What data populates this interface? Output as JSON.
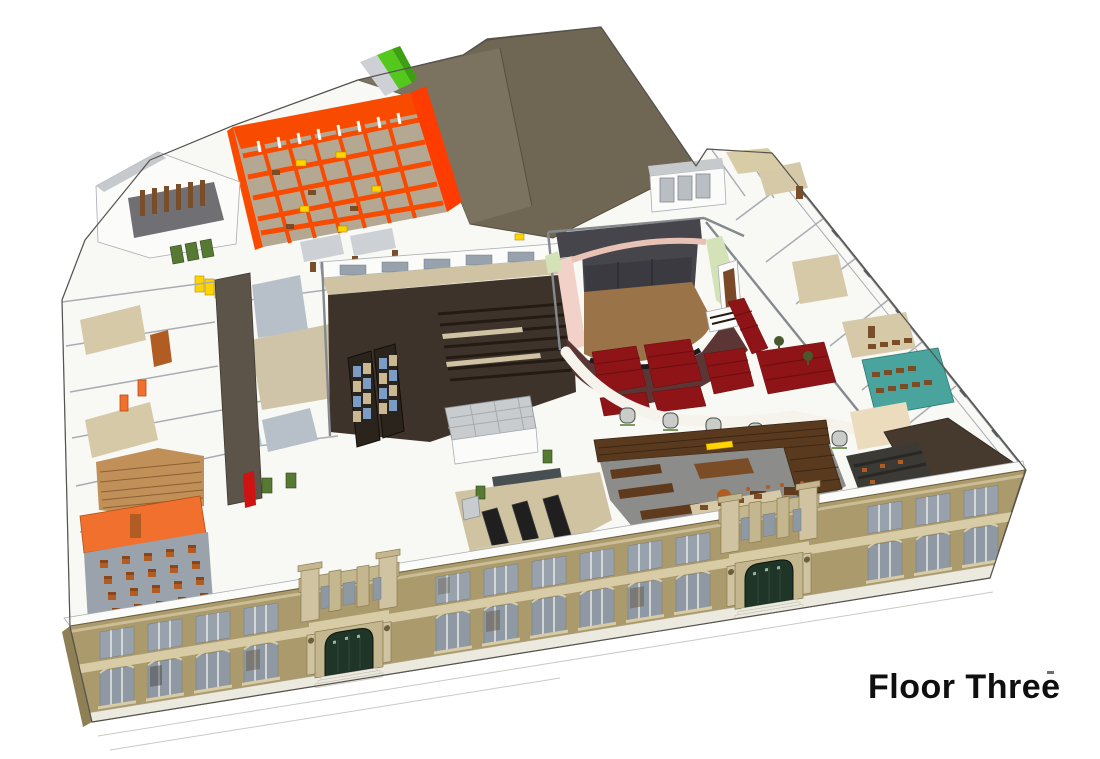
{
  "annotation": {
    "text": "Floor Three"
  },
  "scene": {
    "name": "building-floor-three-axonometric-cutaway",
    "view": "aerial cutaway 3d rendering of a school and theater building, third floor exposed",
    "regions": [
      {
        "name": "stage-house",
        "feature": "tall windowless fly-tower block",
        "palette": "stagehouse"
      },
      {
        "name": "orange-wing",
        "feature": "orange open-frame wing with grid of bays and study furniture",
        "palette": "orange"
      },
      {
        "name": "rooftop-green-wedges",
        "feature": "small bright green roof wedges",
        "palette": "green_bright"
      },
      {
        "name": "northwest-stair-block",
        "feature": "stair penthouse with brown posts",
        "palette": "post_brown"
      },
      {
        "name": "green-door-trio",
        "feature": "three green doors",
        "palette": "green_door"
      },
      {
        "name": "yellow-lockers",
        "feature": "yellow locker bank",
        "palette": "yellow"
      },
      {
        "name": "corridor-spine",
        "feature": "dark corridor running front to back",
        "palette": "corridor"
      },
      {
        "name": "west-classrooms",
        "feature": "small rooms with tan and blue-gray floors, orange doors, one red door",
        "palette": "blue_gray"
      },
      {
        "name": "wood-floor-room",
        "feature": "plank floored room",
        "palette": "wood"
      },
      {
        "name": "gym-hall",
        "feature": "dark double-height hall with bleachers and stained-glass doors",
        "palette": "gym_dark"
      },
      {
        "name": "skylight-penthouse",
        "feature": "gray skylight box",
        "palette": "skylight"
      },
      {
        "name": "lab-room",
        "feature": "room with three long black benches",
        "palette": "bench_black"
      },
      {
        "name": "theater",
        "feature": "auditorium with pink proscenium, green walls, brown stage, dark red seating",
        "palette": "seat_red"
      },
      {
        "name": "balcony-arcade",
        "feature": "white curved balcony front over arched openings",
        "palette": "arch_gray"
      },
      {
        "name": "library",
        "feature": "reading room ringed by dark bookshelves with desks and round table",
        "palette": "shelf_brown"
      },
      {
        "name": "teal-classroom",
        "feature": "teal floored classroom with brown desks",
        "palette": "teal"
      },
      {
        "name": "corner-dark-room",
        "feature": "dark brown room at right corner",
        "palette": "dark_room"
      },
      {
        "name": "front-classroom",
        "feature": "classroom with orange wall and grid of orange chairs",
        "palette": "class_orange"
      },
      {
        "name": "facade",
        "feature": "tan brick street facade with window bays and two stone entrance portals",
        "palette": "facade"
      },
      {
        "name": "entrance-portal-left",
        "feature": "stone portal, green doors, steps",
        "palette": "facade_stone"
      },
      {
        "name": "entrance-portal-right",
        "feature": "stone portal, green doors, steps",
        "palette": "facade_stone"
      },
      {
        "name": "ground-lines",
        "feature": "faint sidewalk lines",
        "palette": "ground_line"
      }
    ]
  },
  "palette": {
    "bg": "#ffffff",
    "ink": "#0f0f0f",
    "mark": "#6e6e6e",
    "edge": "#55534e",
    "plate": "#f8f8f5",
    "wall_top": "#a9adb2",
    "wall2": "#85898d",
    "tick": "#5a6068",
    "side_shadow": "#8e7f55",
    "facade": "#ab9a6c",
    "facade_edge": "#6b5f3a",
    "facade_trim": "#d8cca6",
    "facade_stone": "#cfc3a2",
    "facade_stone_dark": "#c4b78f",
    "stone_edge": "#8a7c50",
    "glass": "#97a2ac",
    "glass_dark": "#8e99a4",
    "glass_edge": "#767d84",
    "mullion": "#e8e8e8",
    "foundation": "#eceadf",
    "step_edge": "#b5b2a5",
    "door_green_dark": "#1f3527",
    "door_dark_edge": "#0a140e",
    "door_line": "#33493a",
    "door_speck": "#9fb3a4",
    "stagehouse": "#6f6654",
    "stagehouse_light": "#7b7260",
    "sh_edge": "#57503f",
    "orange": "#f84b00",
    "orange_bright": "#ff3c00",
    "orange_floor": "#b5a893",
    "yellow": "#ffd400",
    "yellow_edge": "#b08f00",
    "green_bright": "#55c81e",
    "green_bright_dark": "#3da012",
    "green_door": "#567a33",
    "green_door_edge": "#2e4418",
    "pink": "#f2d2c8",
    "pink_soft": "#e9c2b6",
    "mint": "#d4e2b8",
    "backdrop": "#45454b",
    "backdrop_dark": "#3a3a40",
    "backdrop_line": "#2c2c30",
    "stage_brown": "#9a7348",
    "pit": "#1c1c1c",
    "house_maroon": "#5b3634",
    "seat_red": "#8e1418",
    "seat_red_dark": "#6b0e10",
    "balcony": "#f6f3ec",
    "arch_gray": "#c9ccc9",
    "arch_edge": "#4a4f4a",
    "organ_brown": "#7a4a28",
    "tree_green": "#49592e",
    "trunk": "#5a4a32",
    "gym_dark": "#3e332a",
    "gym_beige": "#cfc3a4",
    "bleach_line": "#241c14",
    "door_panel": "#2b241c",
    "door_panel_edge": "#120e0a",
    "glass_blue": "#7b9cc4",
    "glass_tan": "#c9b892",
    "corridor": "#5d5449",
    "corridor_edge": "#3e382f",
    "slate": "#474f52",
    "skylight": "#c9ccce",
    "skylight_edge": "#8a8f93",
    "skylight_line": "#a6abaf",
    "lab_floor": "#cfc3a2",
    "bench_black": "#1f1f1f",
    "bench_edge": "#3a3a3a",
    "shelf_brown": "#5a3a1e",
    "shelf_dark": "#3c2713",
    "lib_floor": "#8c8c8a",
    "desk_brown": "#7a4d26",
    "desk_top": "#5f3a1c",
    "teal": "#49a49e",
    "teal_edge": "#2e7a74",
    "peach": "#ecdcbe",
    "dark_room": "#46392e",
    "dark_room_edge": "#2e2620",
    "dark_class": "#3c3a35",
    "dark_row": "#2a2824",
    "chair_orange": "#b05c22",
    "chair_back": "#8a4518",
    "class_gray": "#9aa2ac",
    "class_orange": "#f2702e",
    "class_orange_edge": "#b24e12",
    "red_accent": "#cf1212",
    "wood": "#c09058",
    "wood_line": "#8a5f34",
    "blue_gray": "#b7bfc8",
    "hall_beige": "#cfc3a8",
    "tan_floor": "#d5c9a8",
    "white_wall": "#fbfbf9",
    "gray_roof": "#c6cacd",
    "gray_light": "#cdd1d5",
    "floor_gray": "#707074",
    "post_brown": "#7a4e28",
    "interior_hint": "#6b5e50",
    "interior_dark": "#474747",
    "pent_door": "#b9bec3",
    "pent_door_edge": "#84898e",
    "ground_line": "#c9c9c6"
  }
}
